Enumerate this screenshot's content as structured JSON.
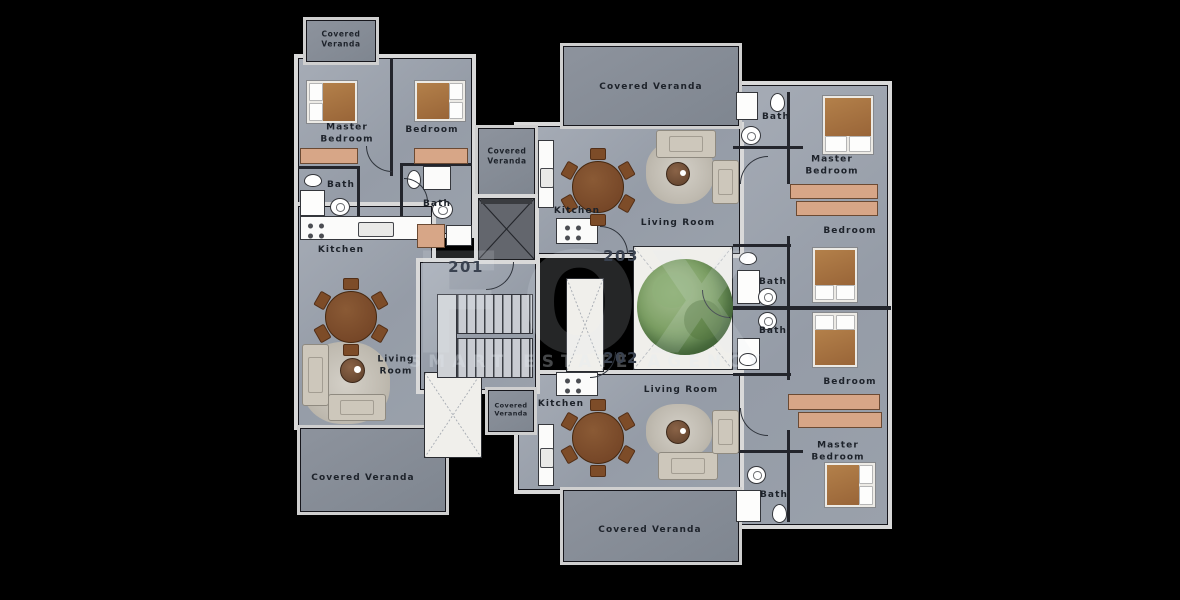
{
  "plan_title": "Apartment floor plan",
  "units": {
    "left": "201",
    "top": "203",
    "bottom": "202"
  },
  "watermark": {
    "logo": "FOX",
    "text": "SMART ESTATE AGENCY"
  },
  "palette": {
    "background": "#000000",
    "floor": "#9aa1ab",
    "veranda": "#868d97",
    "wall": "#d9d9d9",
    "wardrobe": "#d7a687",
    "bed_blanket": "#a5743f",
    "table_wood": "#7a4a28",
    "tree": "#7da065",
    "label_text": "#1d222a"
  },
  "rooms": [
    {
      "key": "veranda-top-left",
      "label": "Covered Veranda"
    },
    {
      "key": "master-bedroom-left",
      "label": "Master Bedroom"
    },
    {
      "key": "bedroom-left",
      "label": "Bedroom"
    },
    {
      "key": "bath-left-1",
      "label": "Bath"
    },
    {
      "key": "bath-left-2",
      "label": "Bath"
    },
    {
      "key": "kitchen-left",
      "label": "Kitchen"
    },
    {
      "key": "living-room-left",
      "label": "Living Room"
    },
    {
      "key": "veranda-bottom-left",
      "label": "Covered Veranda"
    },
    {
      "key": "veranda-mid-top",
      "label": "Covered Veranda"
    },
    {
      "key": "veranda-mid-bottom",
      "label": "Covered Veranda"
    },
    {
      "key": "veranda-top-center",
      "label": "Covered Veranda"
    },
    {
      "key": "kitchen-203",
      "label": "Kitchen"
    },
    {
      "key": "living-room-203",
      "label": "Living Room"
    },
    {
      "key": "bath-203",
      "label": "Bath"
    },
    {
      "key": "master-bedroom-top-right",
      "label": "Master Bedroom"
    },
    {
      "key": "bedroom-top-right",
      "label": "Bedroom"
    },
    {
      "key": "bath-right-upper",
      "label": "Bath"
    },
    {
      "key": "bath-right-lower",
      "label": "Bath"
    },
    {
      "key": "bedroom-bottom-right",
      "label": "Bedroom"
    },
    {
      "key": "master-bedroom-bottom-right",
      "label": "Master Bedroom"
    },
    {
      "key": "bath-202",
      "label": "Bath"
    },
    {
      "key": "kitchen-202",
      "label": "Kitchen"
    },
    {
      "key": "living-room-202",
      "label": "Living Room"
    },
    {
      "key": "veranda-bottom-center",
      "label": "Covered Veranda"
    }
  ]
}
